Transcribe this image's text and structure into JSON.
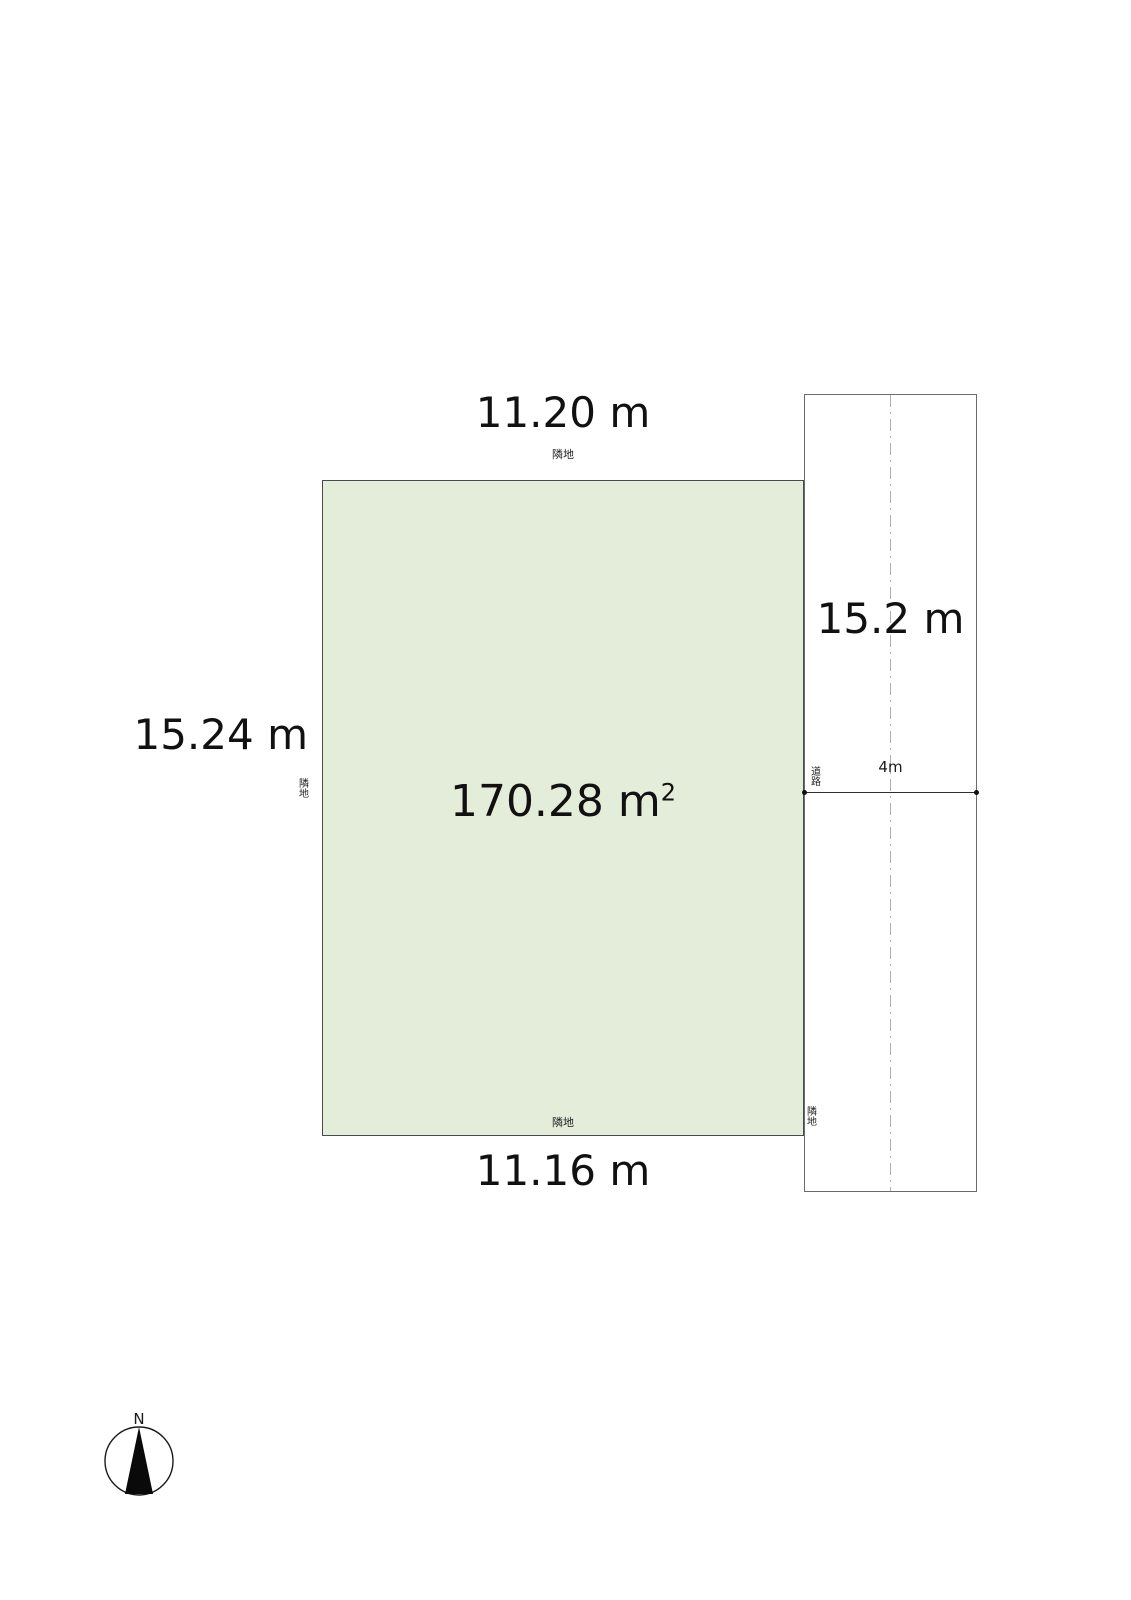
{
  "plot": {
    "fill": "#e4ecda",
    "dim_top": "11.20 m",
    "dim_left": "15.24 m",
    "dim_bottom": "11.16 m",
    "area_value": "170.28 m",
    "area_exponent": "2",
    "adjacent_top": "隣地",
    "adjacent_left": "隣地",
    "adjacent_bottom": "隣地"
  },
  "road": {
    "length_dim": "15.2 m",
    "width_dim": "4m",
    "name_label": "道路",
    "southwest_adjacent": "隣地",
    "centerline_color": "#b0b0b0"
  },
  "compass": {
    "north": "N"
  }
}
